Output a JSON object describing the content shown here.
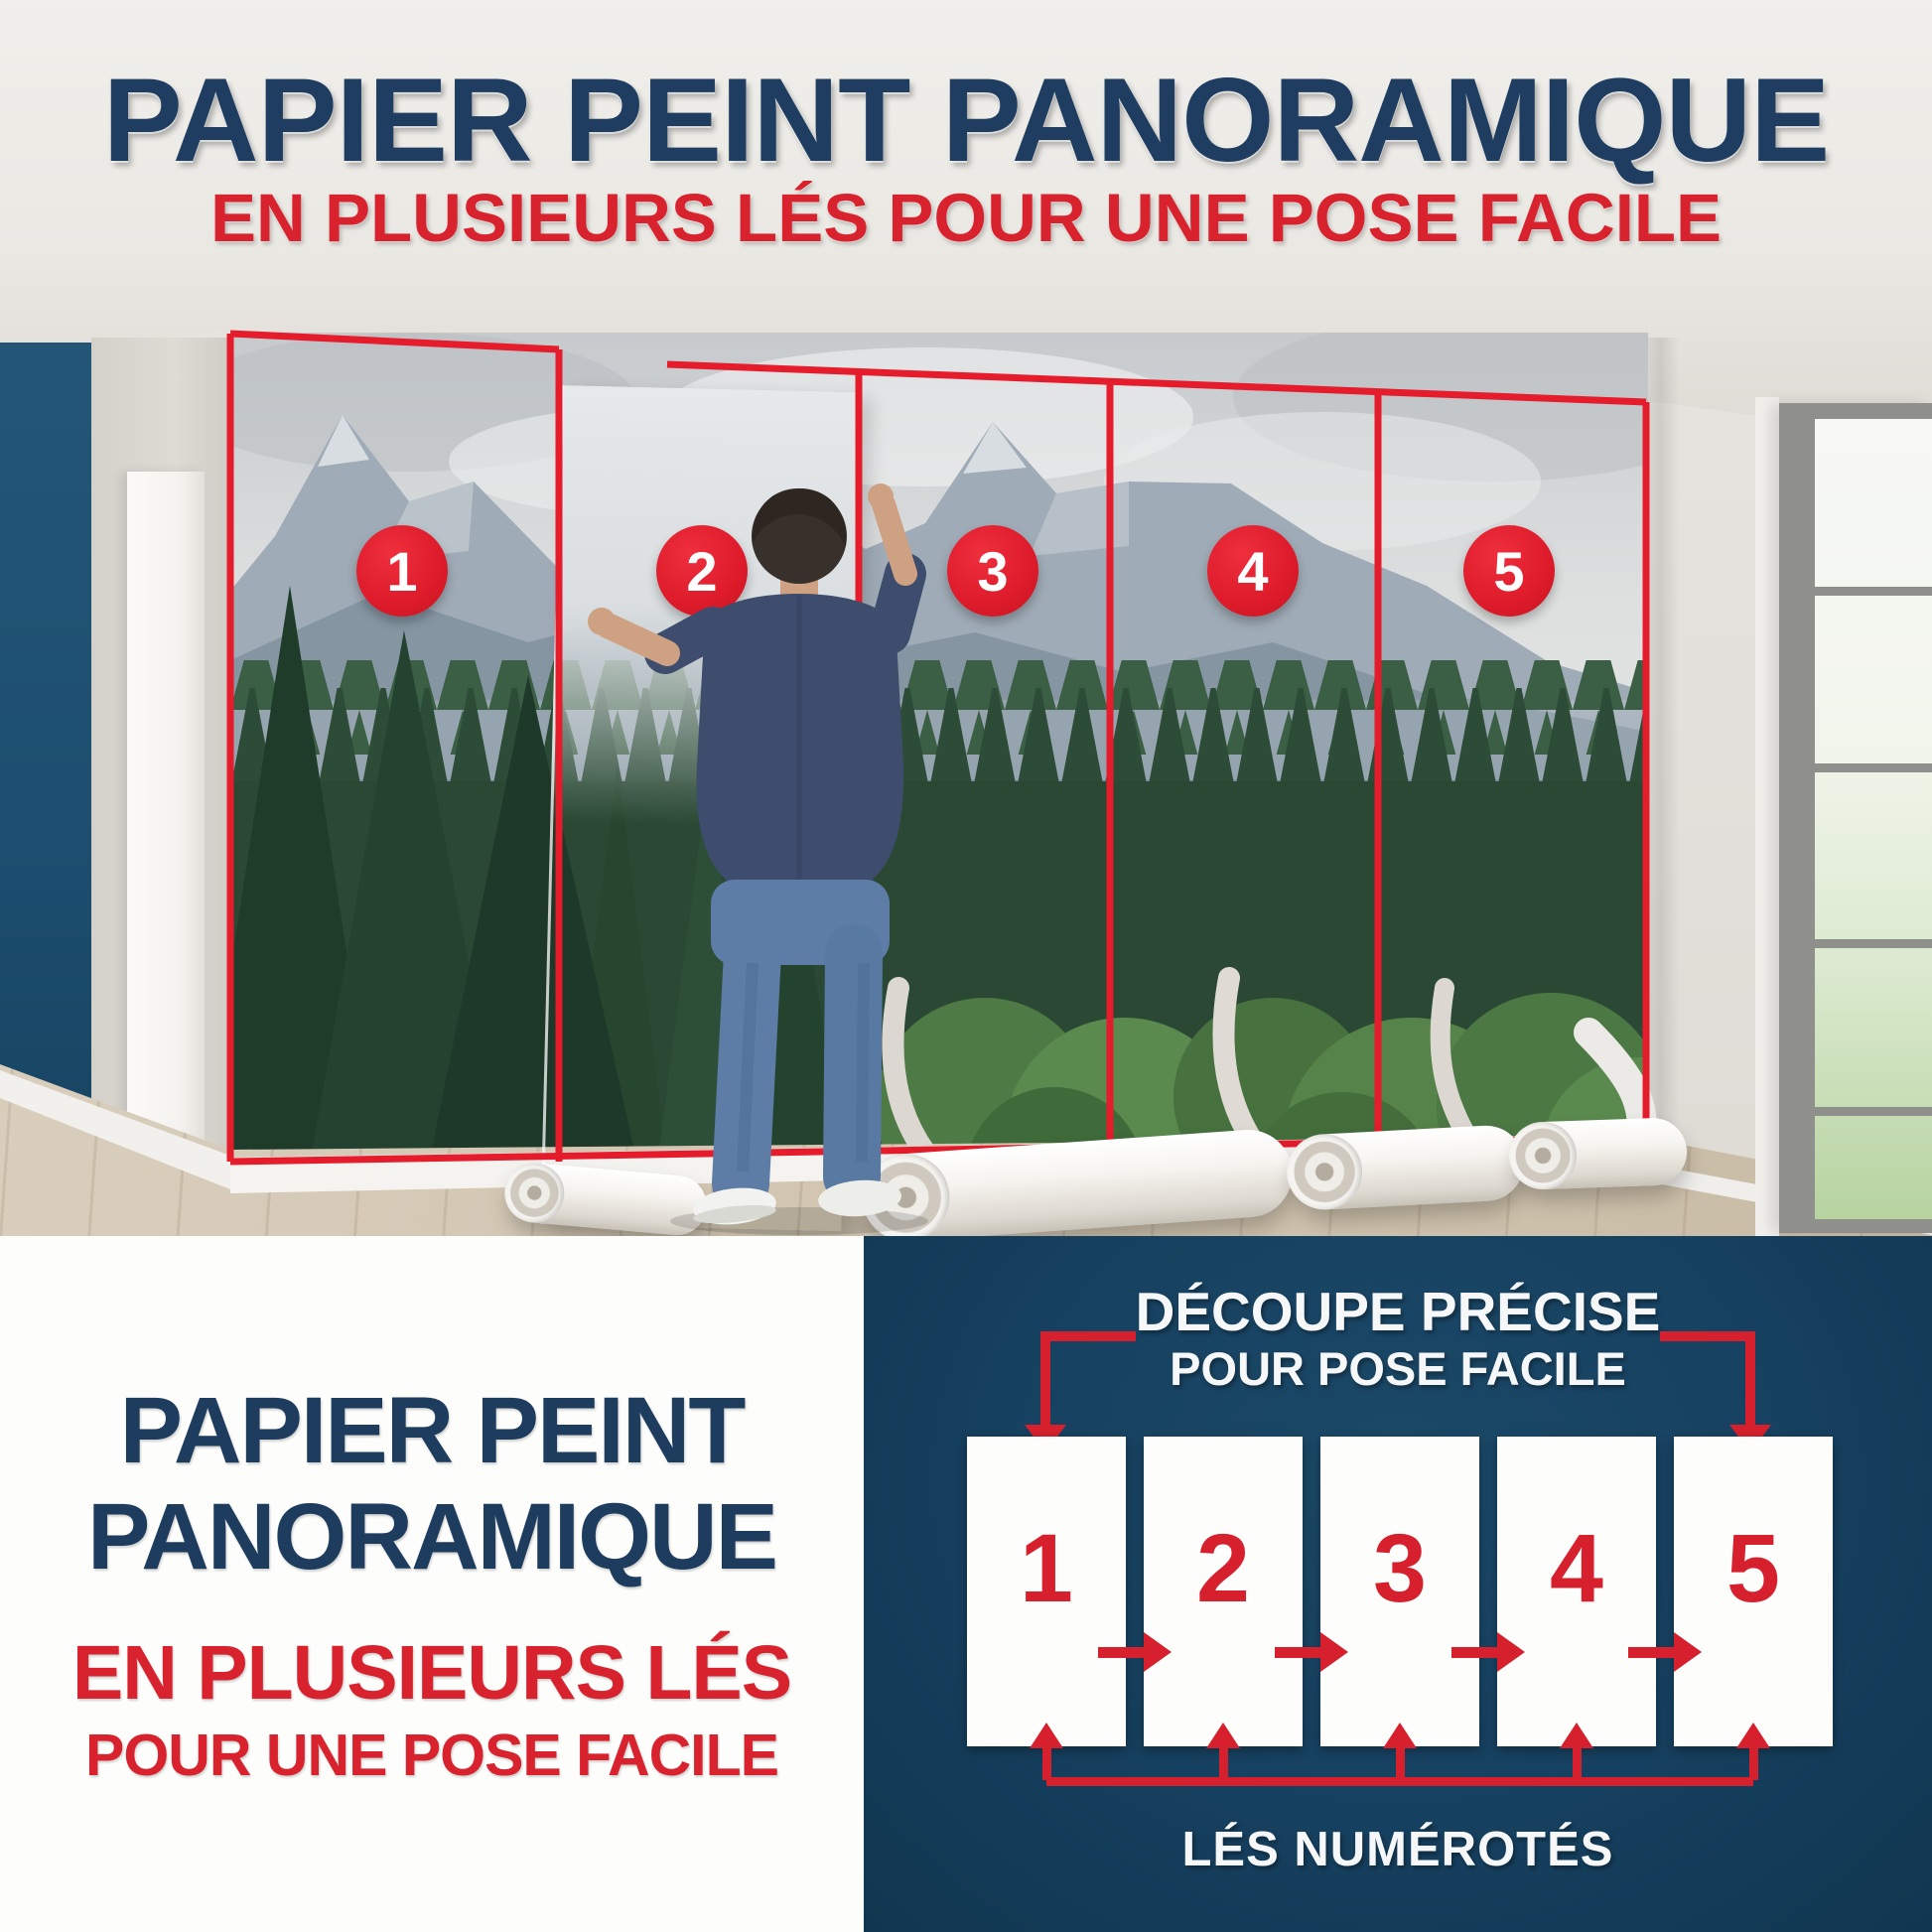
{
  "header": {
    "title": "PAPIER PEINT PANORAMIQUE",
    "subtitle": "EN PLUSIEURS LÉS POUR UNE POSE FACILE"
  },
  "photo": {
    "description": "homme posant un papier peint panoramique montagne et forêt",
    "panel_labels": [
      "1",
      "2",
      "3",
      "4",
      "5"
    ]
  },
  "bottom_left": {
    "line1": "PAPIER PEINT",
    "line2": "PANORAMIQUE",
    "line3": "EN PLUSIEURS LÉS",
    "line4": "POUR UNE POSE FACILE"
  },
  "diagram": {
    "heading_line1": "DÉCOUPE PRÉCISE",
    "heading_line2": "POUR POSE FACILE",
    "panels": [
      "1",
      "2",
      "3",
      "4",
      "5"
    ],
    "footer": "LÉS NUMÉROTÉS"
  },
  "colors": {
    "navy_text": "#1d3c5e",
    "red_text": "#d8232f",
    "badge_red": "#dd1b2b",
    "outline_red": "#e51c2b",
    "panel_blue": "#16405f",
    "accent_wall_blue": "#1f5273",
    "white": "#fdfdfc"
  }
}
